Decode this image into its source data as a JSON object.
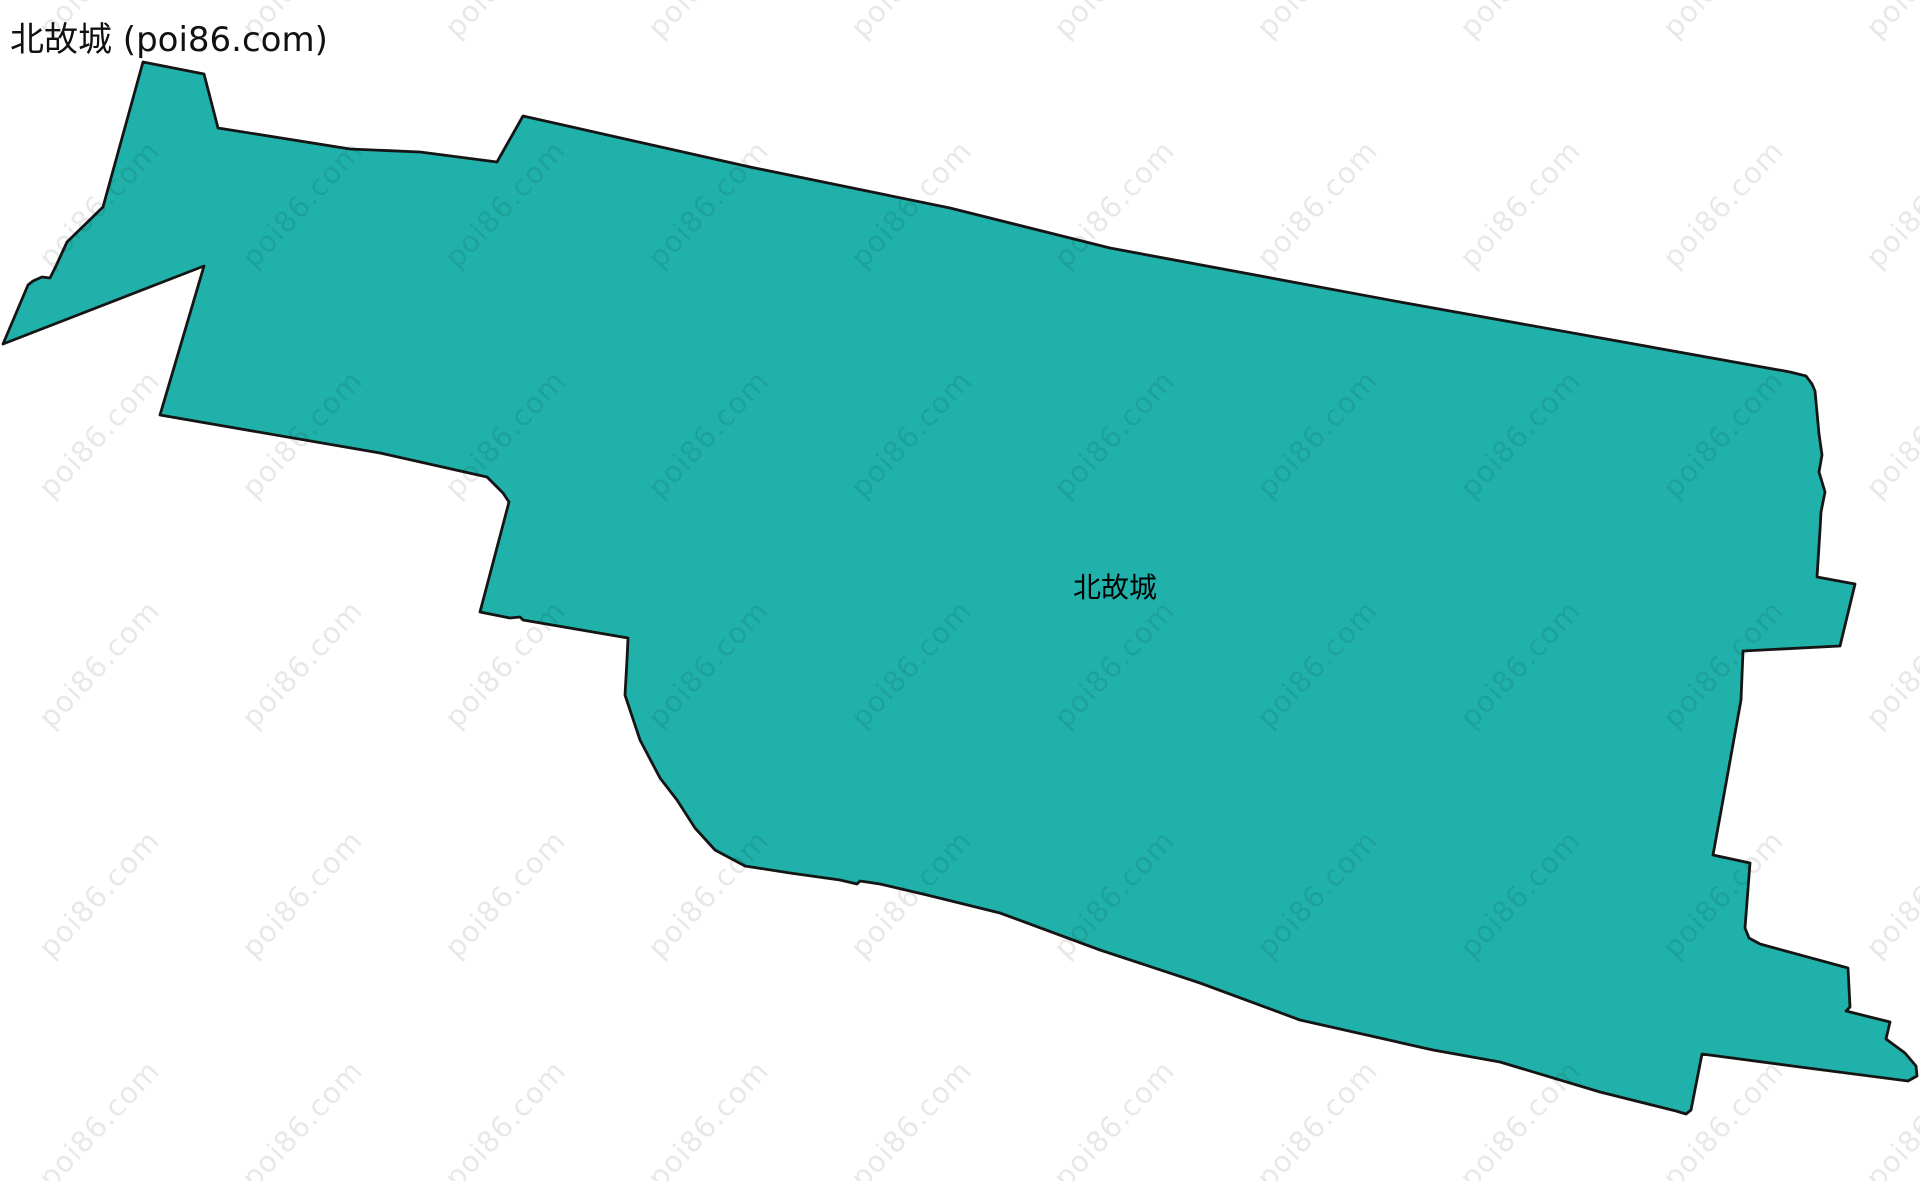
{
  "page": {
    "title": "北故城 (poi86.com)"
  },
  "map": {
    "region_label": "北故城",
    "label_pos": {
      "x": 1115,
      "y": 586
    },
    "fill_color": "#20b2aa",
    "stroke_color": "#151515",
    "stroke_width": 2.8,
    "boundary_points": [
      [
        143,
        62
      ],
      [
        204,
        74
      ],
      [
        218,
        128
      ],
      [
        350,
        149
      ],
      [
        420,
        152
      ],
      [
        497,
        162
      ],
      [
        523,
        116
      ],
      [
        750,
        167
      ],
      [
        950,
        208
      ],
      [
        1110,
        248
      ],
      [
        1400,
        302
      ],
      [
        1790,
        372
      ],
      [
        1806,
        376
      ],
      [
        1812,
        384
      ],
      [
        1815,
        391
      ],
      [
        1819,
        434
      ],
      [
        1822,
        455
      ],
      [
        1819,
        472
      ],
      [
        1825,
        492
      ],
      [
        1821,
        512
      ],
      [
        1820,
        530
      ],
      [
        1817,
        577
      ],
      [
        1855,
        584
      ],
      [
        1840,
        646
      ],
      [
        1743,
        651
      ],
      [
        1741,
        700
      ],
      [
        1723,
        800
      ],
      [
        1713,
        855
      ],
      [
        1750,
        863
      ],
      [
        1745,
        928
      ],
      [
        1749,
        938
      ],
      [
        1760,
        944
      ],
      [
        1848,
        968
      ],
      [
        1850,
        1007
      ],
      [
        1846,
        1011
      ],
      [
        1890,
        1022
      ],
      [
        1886,
        1039
      ],
      [
        1905,
        1053
      ],
      [
        1916,
        1066
      ],
      [
        1917,
        1076
      ],
      [
        1908,
        1081
      ],
      [
        1800,
        1067
      ],
      [
        1702,
        1054
      ],
      [
        1691,
        1110
      ],
      [
        1686,
        1114
      ],
      [
        1676,
        1111
      ],
      [
        1600,
        1092
      ],
      [
        1500,
        1062
      ],
      [
        1433,
        1050
      ],
      [
        1300,
        1020
      ],
      [
        1200,
        983
      ],
      [
        1100,
        950
      ],
      [
        1000,
        913
      ],
      [
        927,
        895
      ],
      [
        880,
        884
      ],
      [
        860,
        881
      ],
      [
        857,
        884
      ],
      [
        840,
        880
      ],
      [
        790,
        873
      ],
      [
        745,
        866
      ],
      [
        715,
        850
      ],
      [
        695,
        828
      ],
      [
        677,
        800
      ],
      [
        660,
        778
      ],
      [
        640,
        740
      ],
      [
        625,
        695
      ],
      [
        627,
        660
      ],
      [
        628,
        638
      ],
      [
        523,
        620
      ],
      [
        520,
        617
      ],
      [
        510,
        618
      ],
      [
        480,
        612
      ],
      [
        509,
        502
      ],
      [
        503,
        493
      ],
      [
        487,
        477
      ],
      [
        380,
        453
      ],
      [
        160,
        415
      ],
      [
        204,
        266
      ],
      [
        3,
        344
      ],
      [
        28,
        285
      ],
      [
        33,
        281
      ],
      [
        42,
        277
      ],
      [
        50,
        278
      ],
      [
        56,
        266
      ],
      [
        67,
        242
      ],
      [
        103,
        207
      ]
    ]
  },
  "watermark": {
    "text": "poi86.com",
    "color": "rgba(0,0,0,0.09)",
    "grid": {
      "x_start": 99,
      "x_step": 203,
      "cols": 10,
      "y_start": -26,
      "y_step": 230,
      "rows": 6
    }
  }
}
